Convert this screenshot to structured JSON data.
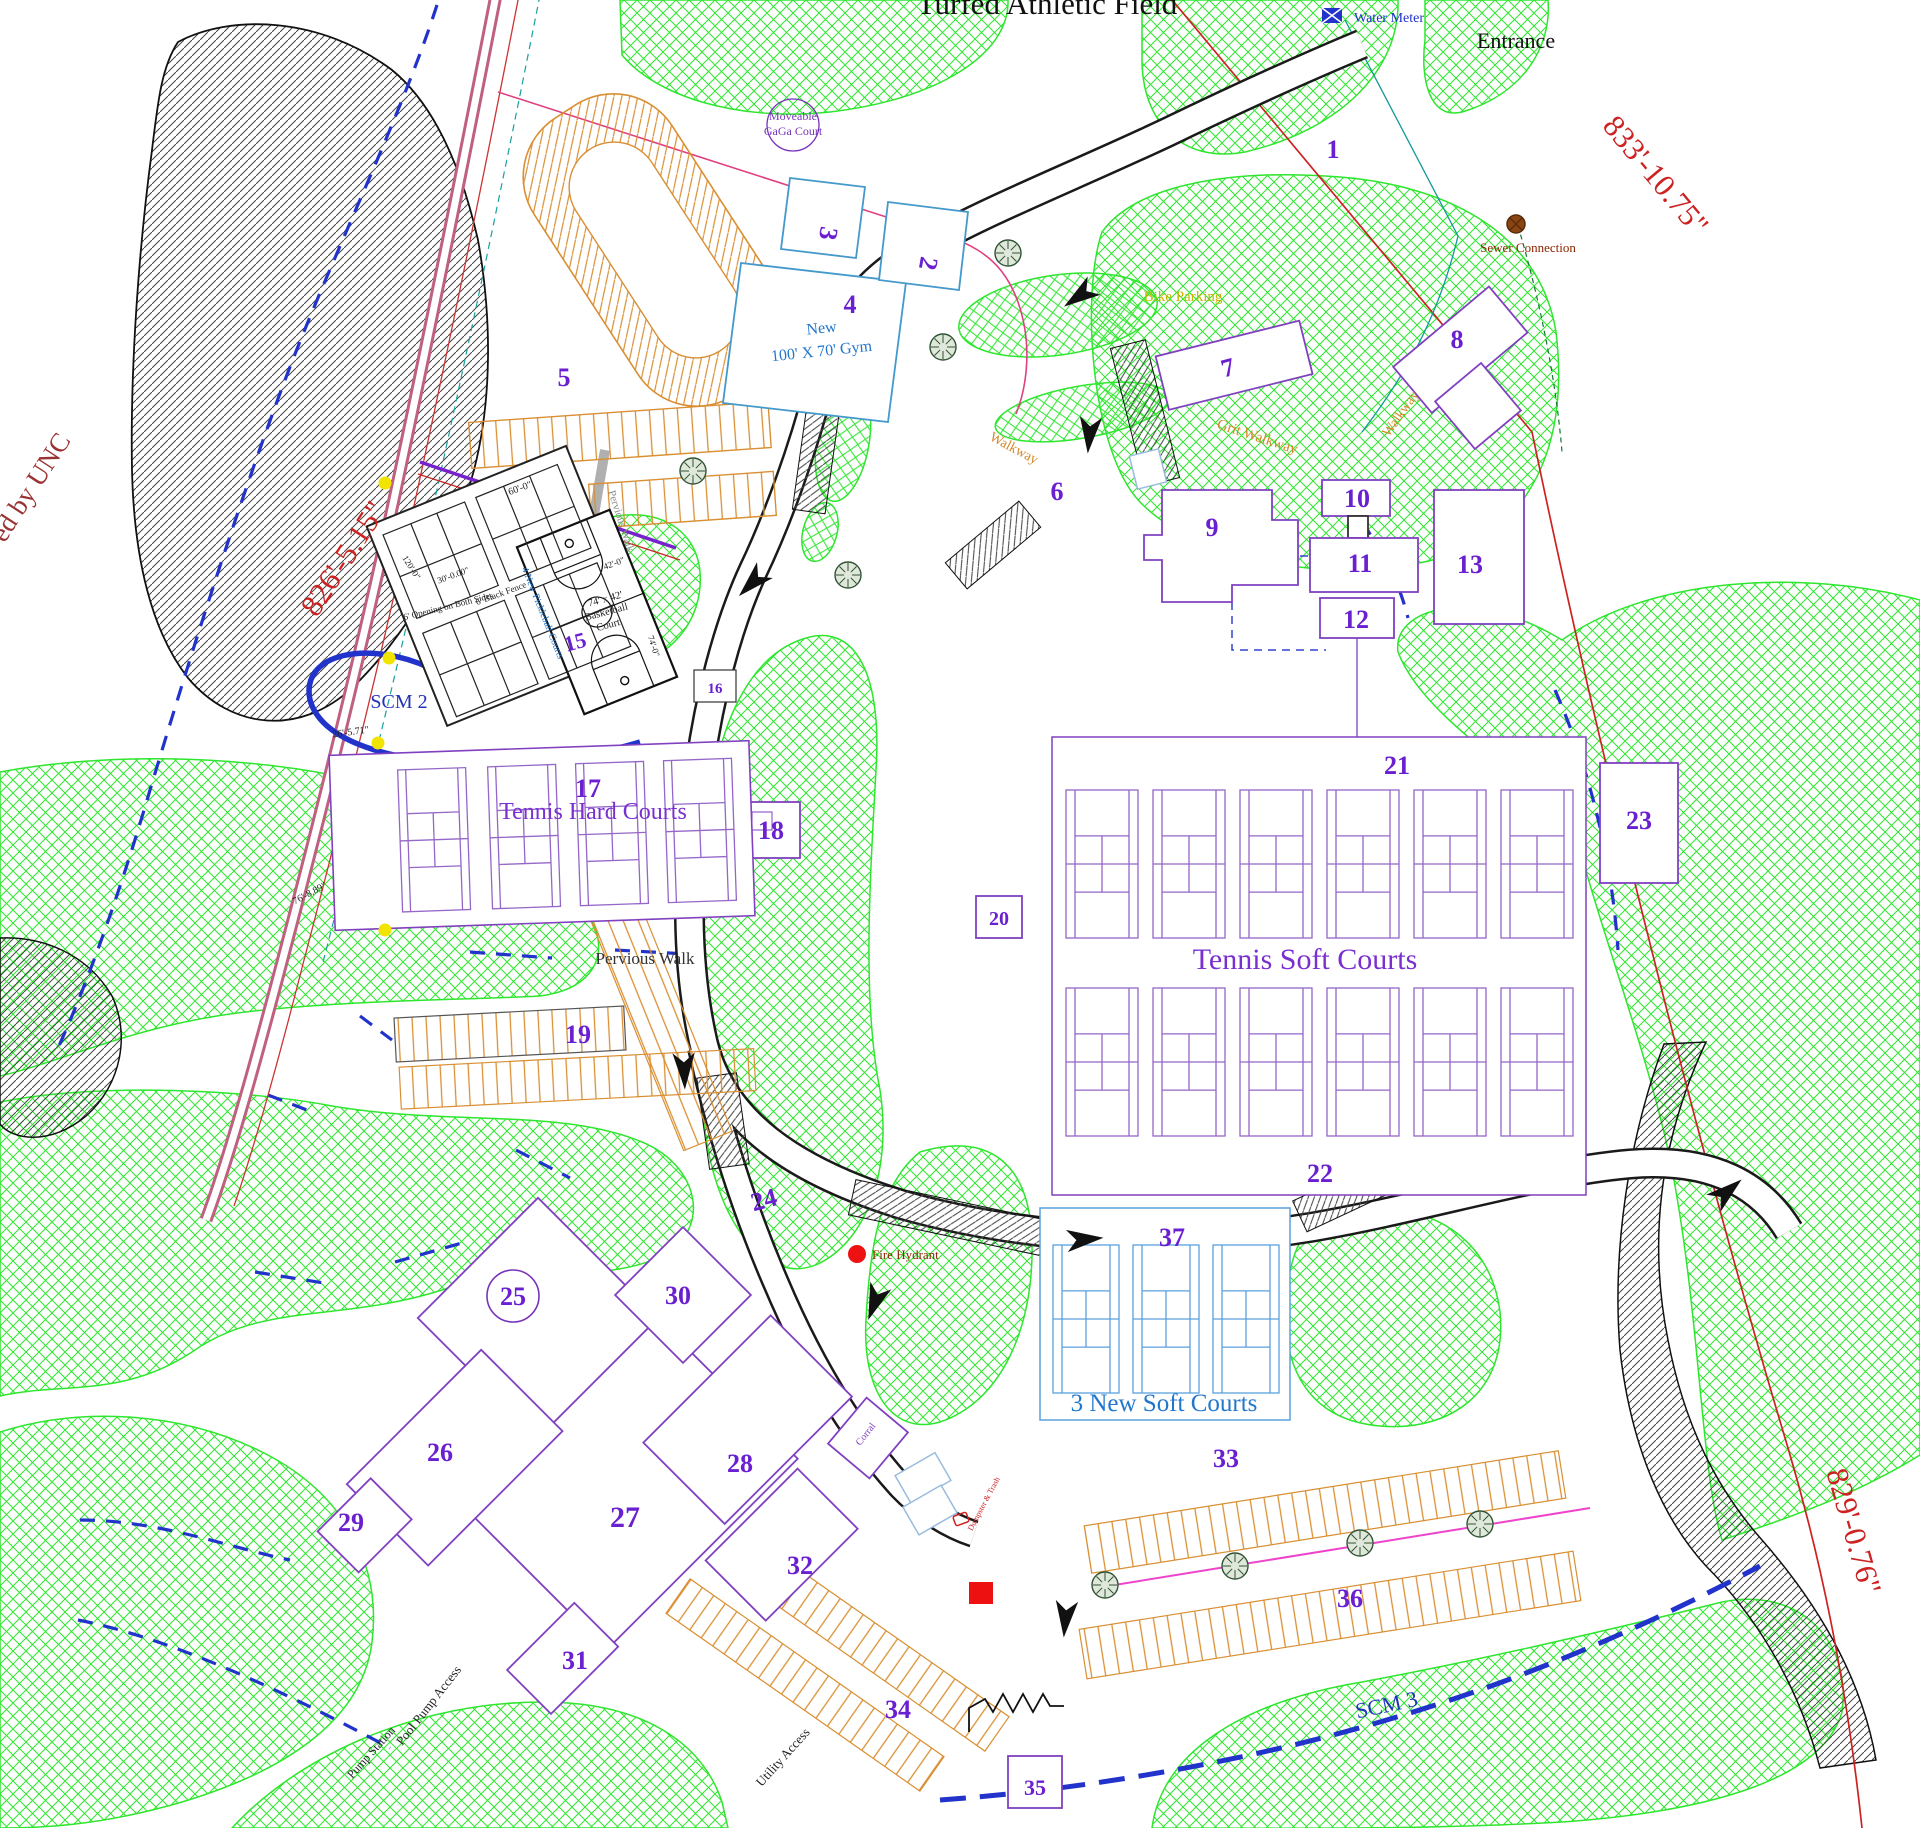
{
  "plan_title": "Turfed Athletic Field",
  "colors": {
    "number_purple": "#6a1fd0",
    "building_purple": "#8040c0",
    "court_purple": "#9467c8",
    "blue_court": "#5aa0dc",
    "blue_text": "#2277cc",
    "scm_blue": "#2233bb",
    "boundary_red": "#cc2222",
    "dark_red": "#8b2500",
    "orange": "#d98f33",
    "green_hatch": "#2ee62e",
    "pink_road": "#c06080",
    "magenta": "#ee44cc",
    "tree_green": "#2F5233",
    "yellow": "#f0e400",
    "teal": "#18a0a0"
  },
  "labels": [
    {
      "name": "field-title",
      "text": "Turfed Athletic Field",
      "x": 1047,
      "y": 14,
      "size": 31,
      "color": "#111111",
      "rot": 0,
      "bold": false
    },
    {
      "name": "water-meter-label",
      "text": "Water Meter",
      "x": 1354,
      "y": 22,
      "size": 14,
      "color": "#2233cc",
      "rot": 0,
      "anchor": "start"
    },
    {
      "name": "entrance-label",
      "text": "Entrance",
      "x": 1516,
      "y": 48,
      "size": 22,
      "color": "#111111",
      "rot": 0
    },
    {
      "name": "boundary-dim-833",
      "text": "833'-10.75\"",
      "x": 1648,
      "y": 182,
      "size": 31,
      "color": "#cc2222",
      "rot": 50
    },
    {
      "name": "boundary-dim-826",
      "text": "826'-5.15\"",
      "x": 352,
      "y": 564,
      "size": 31,
      "color": "#cc2222",
      "rot": -57
    },
    {
      "name": "boundary-dim-829",
      "text": "829'-0.76\"",
      "x": 1844,
      "y": 1534,
      "size": 31,
      "color": "#cc2222",
      "rot": 74
    },
    {
      "name": "maintained-by-unc",
      "text": "ed by UNC",
      "x": 38,
      "y": 492,
      "size": 27,
      "color": "#993333",
      "rot": -57
    },
    {
      "name": "sewer-connection-label",
      "text": "Sewer Connection",
      "x": 1528,
      "y": 252,
      "size": 13,
      "color": "#8b2500",
      "rot": 0
    },
    {
      "name": "gaga-court-line1",
      "text": "Moveable",
      "x": 793,
      "y": 120,
      "size": 12,
      "color": "#7733bb",
      "rot": 0
    },
    {
      "name": "gaga-court-line2",
      "text": "GaGa Court",
      "x": 793,
      "y": 135,
      "size": 12,
      "color": "#7733bb",
      "rot": 0
    },
    {
      "name": "bike-parking-label",
      "text": "Bike Parking",
      "x": 1183,
      "y": 301,
      "size": 15,
      "color": "#c8b400",
      "rot": 0
    },
    {
      "name": "grit-walkway-label",
      "text": "Grit Walkway",
      "x": 1256,
      "y": 441,
      "size": 15,
      "color": "#d2882a",
      "rot": 18
    },
    {
      "name": "walkway-label-east",
      "text": "Walkway",
      "x": 1404,
      "y": 416,
      "size": 14,
      "color": "#d2882a",
      "rot": -55
    },
    {
      "name": "walkway-label-road",
      "text": "Walkway",
      "x": 1012,
      "y": 452,
      "size": 14,
      "color": "#d2882a",
      "rot": 28
    },
    {
      "name": "gym-label-line1",
      "text": "New",
      "x": 822,
      "y": 333,
      "size": 16,
      "color": "#2277cc",
      "rot": -6
    },
    {
      "name": "gym-label-line2",
      "text": "100' X 70' Gym",
      "x": 822,
      "y": 356,
      "size": 16,
      "color": "#2277cc",
      "rot": -6
    },
    {
      "name": "tennis-hard-courts-label",
      "text": "Tennis Hard Courts",
      "x": 593,
      "y": 819,
      "size": 24,
      "color": "#7a2fd0",
      "rot": 0
    },
    {
      "name": "tennis-soft-courts-label",
      "text": "Tennis Soft Courts",
      "x": 1305,
      "y": 969,
      "size": 30,
      "color": "#7a2fd0",
      "rot": 0
    },
    {
      "name": "new-soft-courts-label",
      "text": "3 New Soft Courts",
      "x": 1164,
      "y": 1411,
      "size": 25,
      "color": "#2277cc",
      "rot": 0
    },
    {
      "name": "pervious-walk-label-1",
      "text": "Pervious Walk",
      "x": 618,
      "y": 522,
      "size": 11,
      "color": "#8a8a8a",
      "rot": 72
    },
    {
      "name": "pervious-walk-label-2",
      "text": "Pervious Walk",
      "x": 645,
      "y": 964,
      "size": 17,
      "color": "#333333",
      "rot": 0
    },
    {
      "name": "scm2-label",
      "text": "SCM 2",
      "x": 399,
      "y": 708,
      "size": 20,
      "color": "#2233bb",
      "rot": 0
    },
    {
      "name": "scm3-label",
      "text": "SCM 3",
      "x": 1388,
      "y": 1712,
      "size": 22,
      "color": "#2233bb",
      "rot": -12
    },
    {
      "name": "fire-hydrant-label",
      "text": "Fire Hydrant",
      "x": 872,
      "y": 1259,
      "size": 13,
      "color": "#8b2500",
      "rot": 0,
      "anchor": "start"
    },
    {
      "name": "basketball-dim-line1",
      "text": "74' x 42'",
      "x": 606,
      "y": 602,
      "size": 10.5,
      "color": "#222222",
      "rot": -15
    },
    {
      "name": "basketball-dim-line2",
      "text": "Basketball",
      "x": 607,
      "y": 615,
      "size": 10.5,
      "color": "#222222",
      "rot": -15
    },
    {
      "name": "basketball-dim-line3",
      "text": "Court",
      "x": 609,
      "y": 628,
      "size": 10.5,
      "color": "#222222",
      "rot": -15
    },
    {
      "name": "dim-60",
      "text": "60'-0\"",
      "x": 521,
      "y": 491,
      "size": 10,
      "color": "#222222",
      "rot": -20
    },
    {
      "name": "dim-30",
      "text": "30'-0.00\"",
      "x": 454,
      "y": 578,
      "size": 9,
      "color": "#222222",
      "rot": -20
    },
    {
      "name": "black-fence-label",
      "text": "6' Black Fence",
      "x": 502,
      "y": 596,
      "size": 9,
      "color": "#222222",
      "rot": -20
    },
    {
      "name": "opening-label",
      "text": "6' Opening on Both Sides",
      "x": 449,
      "y": 609,
      "size": 9,
      "color": "#222222",
      "rot": -14
    },
    {
      "name": "pickleball-label",
      "text": "4 New Pickleball Courts",
      "x": 540,
      "y": 614,
      "size": 10,
      "color": "#2277cc",
      "rot": 68
    },
    {
      "name": "dim-42",
      "text": "42'-0\"",
      "x": 615,
      "y": 566,
      "size": 9,
      "color": "#222222",
      "rot": -20
    },
    {
      "name": "dim-74",
      "text": "74'-0\"",
      "x": 651,
      "y": 647,
      "size": 9,
      "color": "#222222",
      "rot": 72
    },
    {
      "name": "dim-76",
      "text": "76'-8.89\"",
      "x": 311,
      "y": 896,
      "size": 10,
      "color": "#222222",
      "rot": -28
    },
    {
      "name": "dim-26",
      "text": "26'-5.71\"",
      "x": 351,
      "y": 735,
      "size": 10,
      "color": "#222222",
      "rot": -8
    },
    {
      "name": "dim-120",
      "text": "120'-0\"",
      "x": 409,
      "y": 569,
      "size": 9,
      "color": "#222222",
      "rot": 58
    },
    {
      "name": "pool-pump-access-label",
      "text": "Pool Pump Access",
      "x": 432,
      "y": 1708,
      "size": 13,
      "color": "#222222",
      "rot": -52
    },
    {
      "name": "pump-station-label",
      "text": "Pump Station",
      "x": 374,
      "y": 1755,
      "size": 12,
      "color": "#222222",
      "rot": -48
    },
    {
      "name": "utility-access-label",
      "text": "Utility Access",
      "x": 786,
      "y": 1760,
      "size": 13,
      "color": "#222222",
      "rot": -48
    },
    {
      "name": "corral-label",
      "text": "Corral",
      "x": 868,
      "y": 1436,
      "size": 10,
      "color": "#8040c0",
      "rot": -52
    },
    {
      "name": "dumpster-label",
      "text": "Dumpster & Trash",
      "x": 986,
      "y": 1505,
      "size": 8,
      "color": "#cc2222",
      "rot": -62
    }
  ],
  "site_numbers": [
    {
      "n": "1",
      "x": 1333,
      "y": 158
    },
    {
      "n": "2",
      "x": 920,
      "y": 262,
      "rot": 100
    },
    {
      "n": "3",
      "x": 820,
      "y": 232,
      "rot": 100
    },
    {
      "n": "4",
      "x": 850,
      "y": 313
    },
    {
      "n": "5",
      "x": 564,
      "y": 386
    },
    {
      "n": "6",
      "x": 1057,
      "y": 500
    },
    {
      "n": "7",
      "x": 1230,
      "y": 376,
      "rot": -15
    },
    {
      "n": "8",
      "x": 1457,
      "y": 348
    },
    {
      "n": "9",
      "x": 1212,
      "y": 536
    },
    {
      "n": "10",
      "x": 1357,
      "y": 507
    },
    {
      "n": "11",
      "x": 1360,
      "y": 572
    },
    {
      "n": "12",
      "x": 1356,
      "y": 628
    },
    {
      "n": "13",
      "x": 1470,
      "y": 573
    },
    {
      "n": "15",
      "x": 577,
      "y": 649,
      "rot": -15,
      "size": 22
    },
    {
      "n": "16",
      "x": 715,
      "y": 693,
      "size": 15
    },
    {
      "n": "17",
      "x": 588,
      "y": 797
    },
    {
      "n": "18",
      "x": 771,
      "y": 839
    },
    {
      "n": "19",
      "x": 578,
      "y": 1043
    },
    {
      "n": "20",
      "x": 999,
      "y": 925,
      "size": 20
    },
    {
      "n": "21",
      "x": 1397,
      "y": 774
    },
    {
      "n": "22",
      "x": 1320,
      "y": 1182
    },
    {
      "n": "23",
      "x": 1639,
      "y": 829
    },
    {
      "n": "24",
      "x": 766,
      "y": 1208,
      "rot": -15
    },
    {
      "n": "25",
      "x": 513,
      "y": 1305
    },
    {
      "n": "26",
      "x": 440,
      "y": 1461
    },
    {
      "n": "27",
      "x": 625,
      "y": 1527,
      "size": 30
    },
    {
      "n": "28",
      "x": 740,
      "y": 1472
    },
    {
      "n": "29",
      "x": 351,
      "y": 1531
    },
    {
      "n": "30",
      "x": 678,
      "y": 1304
    },
    {
      "n": "31",
      "x": 575,
      "y": 1669
    },
    {
      "n": "32",
      "x": 800,
      "y": 1574
    },
    {
      "n": "33",
      "x": 1226,
      "y": 1467
    },
    {
      "n": "34",
      "x": 898,
      "y": 1718
    },
    {
      "n": "35",
      "x": 1035,
      "y": 1795,
      "size": 22
    },
    {
      "n": "36",
      "x": 1350,
      "y": 1607
    },
    {
      "n": "37",
      "x": 1172,
      "y": 1246
    }
  ],
  "icons": {
    "water_meter_icon": {
      "x": 1322,
      "y": 8
    },
    "sewer_connection_icon": {
      "x": 1516,
      "y": 224
    },
    "fire_hydrant_icon": {
      "x": 857,
      "y": 1254
    },
    "red_square_marker": {
      "x": 969,
      "y": 1582
    },
    "dumpster_marker": {
      "x": 954,
      "y": 1514
    },
    "gaga_circle": {
      "x": 793,
      "y": 125,
      "r": 26
    },
    "circle_25": {
      "x": 513,
      "y": 1296,
      "r": 26
    },
    "tree_icons": [
      [
        1008,
        253
      ],
      [
        943,
        347
      ],
      [
        693,
        471
      ],
      [
        848,
        575
      ],
      [
        1105,
        1585
      ],
      [
        1235,
        1566
      ],
      [
        1360,
        1543
      ],
      [
        1480,
        1524
      ]
    ],
    "yellow_markers": [
      [
        385,
        483
      ],
      [
        389,
        658
      ],
      [
        378,
        743
      ],
      [
        385,
        930
      ]
    ],
    "flow_arrows": [
      [
        1085,
        292,
        235
      ],
      [
        1090,
        428,
        185
      ],
      [
        757,
        578,
        225
      ],
      [
        684,
        1064,
        178
      ],
      [
        1078,
        1240,
        85
      ],
      [
        1722,
        1196,
        50
      ],
      [
        1066,
        1612,
        185
      ],
      [
        877,
        1296,
        200
      ]
    ]
  },
  "courts": {
    "tennis_hard": {
      "number": "17",
      "label": "Tennis Hard Courts",
      "count": 4
    },
    "tennis_soft": {
      "number_top": "21",
      "number_bottom": "22",
      "label": "Tennis Soft Courts",
      "count": 12
    },
    "new_soft": {
      "number": "37",
      "label": "3 New Soft Courts",
      "count": 3
    },
    "pickleball": {
      "label": "4 New Pickleball Courts",
      "count": 4
    },
    "basketball": {
      "number": "15",
      "label": "74' x 42' Basketball Court"
    }
  }
}
